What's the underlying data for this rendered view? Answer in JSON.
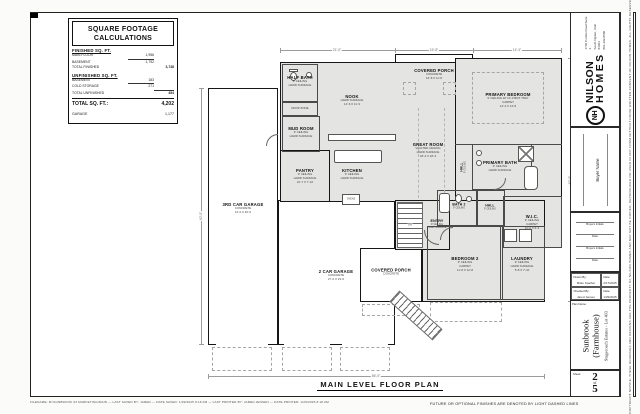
{
  "sheet": {
    "plan_title": "MAIN LEVEL FLOOR PLAN",
    "future_note": "FUTURE OR OPTIONAL FINISHES ARE DENOTED BY LIGHT DASHED LINES",
    "plot_stamp": "FILENAME: M:\\SUNBROOK 03 MARKETING\\MAIN  —  LAST SAVED BY: JARED  —  DATE SAVED: 1/29/2025 8:18 AM  —  LAST PRINTED BY: JARED JENSEN  —  DATE PRINTED: 1/29/2025 8:18 AM"
  },
  "sqft": {
    "title1": "SQUARE FOOTAGE",
    "title2": "CALCULATIONS",
    "finished_header": "FINISHED SQ. FT.",
    "finished_rows": [
      {
        "label": "MAIN FLOOR",
        "value": "1,956"
      },
      {
        "label": "BASEMENT",
        "value": "1,792"
      }
    ],
    "total_finished_label": "TOTAL FINISHED",
    "total_finished_value": "3,748",
    "unfinished_header": "UNFINISHED SQ. FT.",
    "unfinished_rows": [
      {
        "label": "BASEMENT",
        "value": "183"
      },
      {
        "label": "COLD STORAGE",
        "value": "271"
      }
    ],
    "total_unfinished_label": "TOTAL UNFINISHED",
    "total_unfinished_value": "454",
    "grand_total_label": "TOTAL SQ. FT.:",
    "grand_total_value": "4,202",
    "garage_label": "GARAGE",
    "garage_value": "1,177"
  },
  "titleblock": {
    "logo_initials": "NH",
    "brand_line1": "NILSON",
    "brand_line2": "HOMES",
    "address_line1": "1740 Combe Road Suite 2",
    "address_line2": "South Ogden, Utah 84403",
    "address_line3": "801-392-8500",
    "buyer_label": "Buyer Name",
    "sig_rows": [
      "Buyers Initials",
      "Date",
      "Buyers Initials",
      "Date"
    ],
    "drawn_by_label": "Drawn By:",
    "drawn_by_value": "Milan Spather",
    "drawn_date_label": "Date:",
    "drawn_date_value": "2/17/2025",
    "checked_by_label": "Checked By:",
    "checked_by_value": "Jared Jensen",
    "checked_date_label": "Date:",
    "checked_date_value": "1/29/2025",
    "plan_name_label": "Plan Name:",
    "plan_name_line1": "Sunbrook",
    "plan_name_line2": "(Farmhouse)",
    "plan_subtitle": "Stagecoach Estates - Lot 403",
    "sheet_label": "Sheet:",
    "sheet_number": "2",
    "sheet_of": "of",
    "sheet_total": "5",
    "copyright_strip": "COPYRIGHT NOTICE: THESE DRAWINGS AND DESIGNS ARE THE PROPERTY OF NILSON HOMES AND MAY NOT BE COPIED, REPRODUCED OR USED IN ANY FORM WITHOUT PRIOR WRITTEN CONSENT OF NILSON HOMES. ALL RIGHTS RESERVED."
  },
  "rooms": {
    "covered_porch_top": {
      "label": "COVERED PORCH",
      "n1": "CONCRETE",
      "n2": "16'-8 X 11'-8"
    },
    "half_bath": {
      "label": "HALF BATH",
      "n1": "9' CEILING",
      "n2": "HARD SURFACE"
    },
    "drop_zone": {
      "label": "DROP ZONE"
    },
    "mud_room": {
      "label": "MUD ROOM",
      "n1": "9' CEILING",
      "n2": "HARD SURFACE"
    },
    "nook": {
      "label": "NOOK",
      "n1": "HARD SURFACE",
      "n2": "14'-6 X 11'-3"
    },
    "kitchen": {
      "label": "KITCHEN",
      "n1": "9' CEILING",
      "n2": "HARD SURFACE"
    },
    "ovens": {
      "label": "OVENS"
    },
    "pantry": {
      "label": "PANTRY",
      "n1": "9' CEILING",
      "n2": "HARD SURFACE",
      "n3": "10'-7 X 7'-10"
    },
    "great_room": {
      "label": "GREAT ROOM",
      "n1": "VAULTED CEILING",
      "n2": "HARD SURFACE",
      "n3": "18'-4 X 18'-4"
    },
    "primary_bedroom": {
      "label": "PRIMARY BEDROOM",
      "n1": "9' CEILING W/ 10'-0 BOX TRAY",
      "n2": "CARPET",
      "n3": "14'-4 X 13'-8"
    },
    "primary_bath": {
      "label": "PRIMARY BATH",
      "n1": "9' CEILING",
      "n2": "HARD SURFACE"
    },
    "hall1": {
      "label": "HALL",
      "n1": "9' CEILING"
    },
    "wic": {
      "label": "W.I.C.",
      "n1": "9' CEILING",
      "n2": "CARPET",
      "n3": "12'-0 X 6'-4"
    },
    "bath2": {
      "label": "BATH 2",
      "n1": "9' CEILING"
    },
    "hall2": {
      "label": "HALL",
      "n1": "9' CEILING"
    },
    "entry": {
      "label": "ENTRY",
      "n1": "9' CEILING",
      "n2": "HARD SURFACE"
    },
    "bedroom2": {
      "label": "BEDROOM 2",
      "n1": "9' CEILING",
      "n2": "CARPET",
      "n3": "11'-8 X 12'-8"
    },
    "laundry": {
      "label": "LAUNDRY",
      "n1": "9' CEILING",
      "n2": "HARD SURFACE",
      "n3": "5'-8 X 7'-10"
    },
    "covered_porch_bottom": {
      "label": "COVERED PORCH",
      "n1": "CONCRETE"
    },
    "garage3": {
      "label": "3RD CAR GARAGE",
      "n1": "CONCRETE",
      "n2": "12'-0 X 40'-0"
    },
    "garage2": {
      "label": "2 CAR GARAGE",
      "n1": "CONCRETE",
      "n2": "27'-0 X 23'-0"
    },
    "stair_dn": {
      "label": "DN"
    }
  },
  "dims": {
    "top1": "21'-0\"",
    "top2": "16'-8\"",
    "top3": "14'-4\"",
    "right": "62'-0\"",
    "left": "40'-0\"",
    "bottom": "56'-0\""
  }
}
